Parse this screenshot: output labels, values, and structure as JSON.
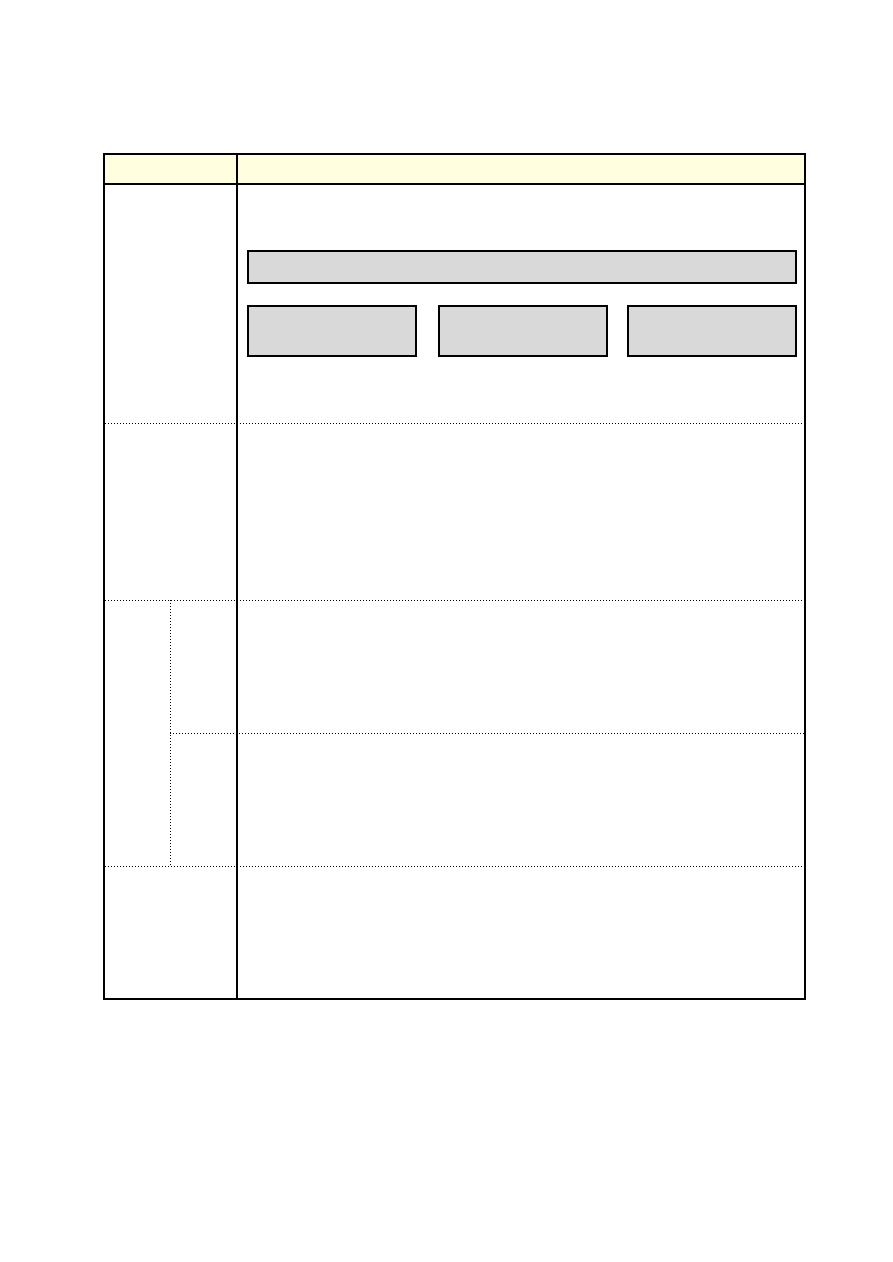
{
  "page": {
    "background": "#FFFFFF"
  },
  "colors": {
    "header_fill": "#FFFFE0",
    "placeholder_fill": "#D9D9D9",
    "border": "#000000"
  },
  "table": {
    "header": {
      "left_label": "",
      "right_label": ""
    },
    "rows": [
      {
        "label": "",
        "content": ""
      },
      {
        "label": "",
        "content": ""
      },
      {
        "label": "",
        "sub_rows": [
          {
            "label": "",
            "content": ""
          },
          {
            "label": "",
            "content": ""
          }
        ]
      },
      {
        "label": "",
        "content": ""
      }
    ],
    "placeholders": {
      "bar_count": 1,
      "box_count": 3
    }
  }
}
